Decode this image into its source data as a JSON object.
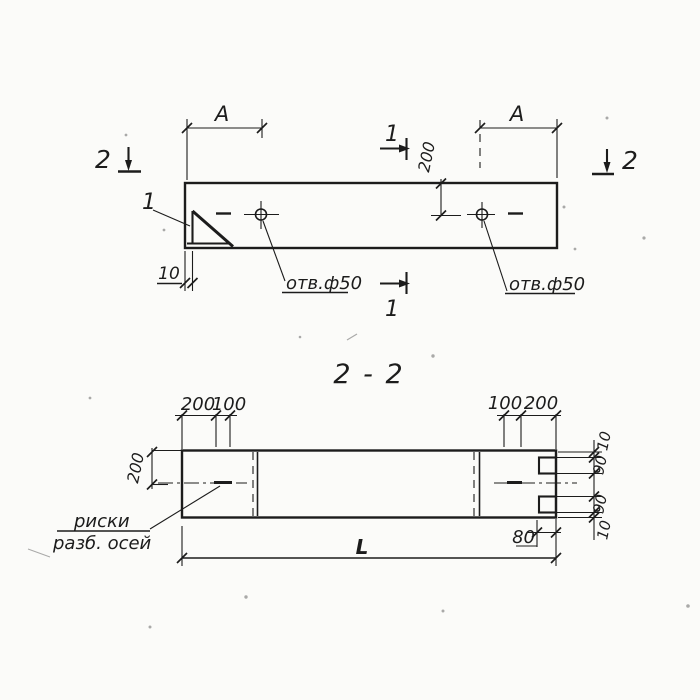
{
  "colors": {
    "ink": "#1c1c1c",
    "paper": "#fbfbf9"
  },
  "plan_view": {
    "dim_a_left": "A",
    "dim_a_right": "A",
    "dim_hole_offset_200": "200",
    "dim_lip_10": "10",
    "hole_label_left": "отв.ф50",
    "hole_label_right": "отв.ф50",
    "detail_callout_1": "1",
    "section_mark_1_top": "1",
    "section_mark_1_bottom": "1",
    "section_mark_2_left": "2",
    "section_mark_2_right": "2"
  },
  "section_view": {
    "title": "2 - 2",
    "top_dims_left": [
      "200",
      "100"
    ],
    "top_dims_right": [
      "100",
      "200"
    ],
    "dim_height_200": "200",
    "right_dims": [
      "10",
      "90",
      "90",
      "10"
    ],
    "dim_notch_80": "80",
    "dim_length_L": "L",
    "axes_note_line1": "риски",
    "axes_note_line2": "разб. осей"
  }
}
